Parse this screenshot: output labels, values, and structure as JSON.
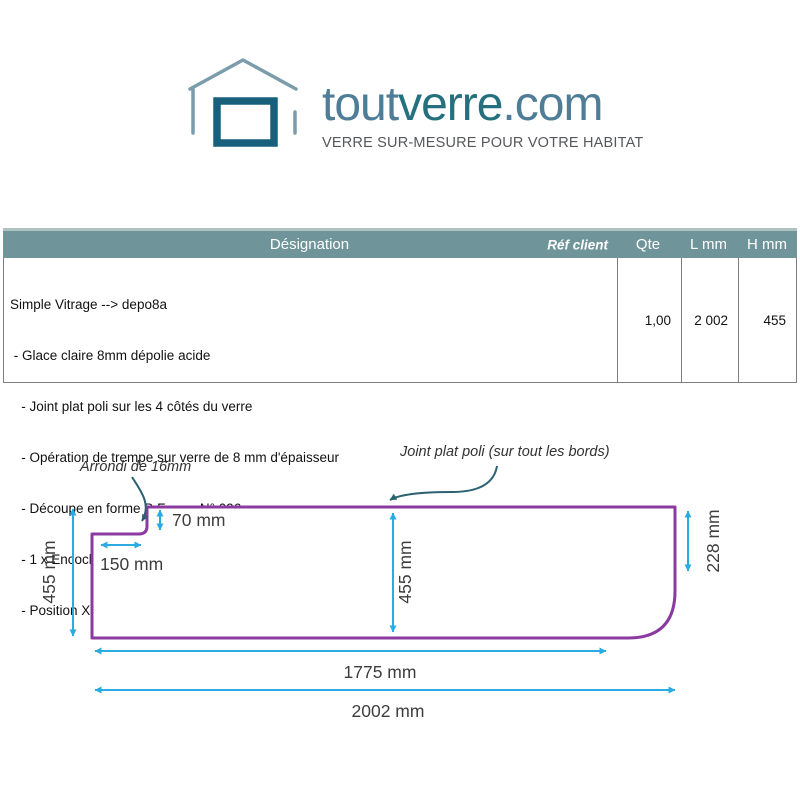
{
  "logo": {
    "brand": {
      "tout": "tout",
      "verre": "verre",
      "com": ".com"
    },
    "tagline": "VERRE SUR-MESURE POUR VOTRE HABITAT",
    "colors": {
      "brand_light": "#4f7d98",
      "brand_dark": "#25707f",
      "house_outline": "#7b9cab",
      "window": "#16607b",
      "tagline_gray": "#57585c"
    }
  },
  "table": {
    "headers": {
      "designation": "Désignation",
      "ref_client": "Réf client",
      "qty": "Qte",
      "l_mm": "L mm",
      "h_mm": "H mm"
    },
    "header_bg": "#6f959b",
    "row": {
      "designation_lines": [
        "Simple Vitrage --> depo8a",
        " - Glace claire 8mm dépolie acide",
        "   - Joint plat poli sur les 4 côtés du verre",
        "   - Opération de trempe sur verre de 8 mm d'épaisseur",
        "   - Découpe en forme B Forme N° 096",
        "   - 1 x Encoche de coin standard AA",
        "   - Position X -->0 - Position Y -->0 - Largeur -->150 - Hauteur -->70 - Rayon -->16"
      ],
      "qty": "1,00",
      "l_mm": "2 002",
      "h_mm": "455"
    }
  },
  "diagram": {
    "callouts": {
      "corner_radius": "Arrondi de 16mm",
      "edge_finish": "Joint plat poli (sur tout les bords)"
    },
    "dimensions": {
      "left_height": "455 mm",
      "notch_width": "150 mm",
      "notch_height": "70 mm",
      "center_height": "455 mm",
      "right_straight_height": "228 mm",
      "bottom_straight_width": "1775 mm",
      "total_width": "2002 mm"
    },
    "colors": {
      "shape_outline": "#8a3aa0",
      "dimension_arrows": "#2aabe2",
      "callout_arrows": "#2c6172"
    }
  }
}
